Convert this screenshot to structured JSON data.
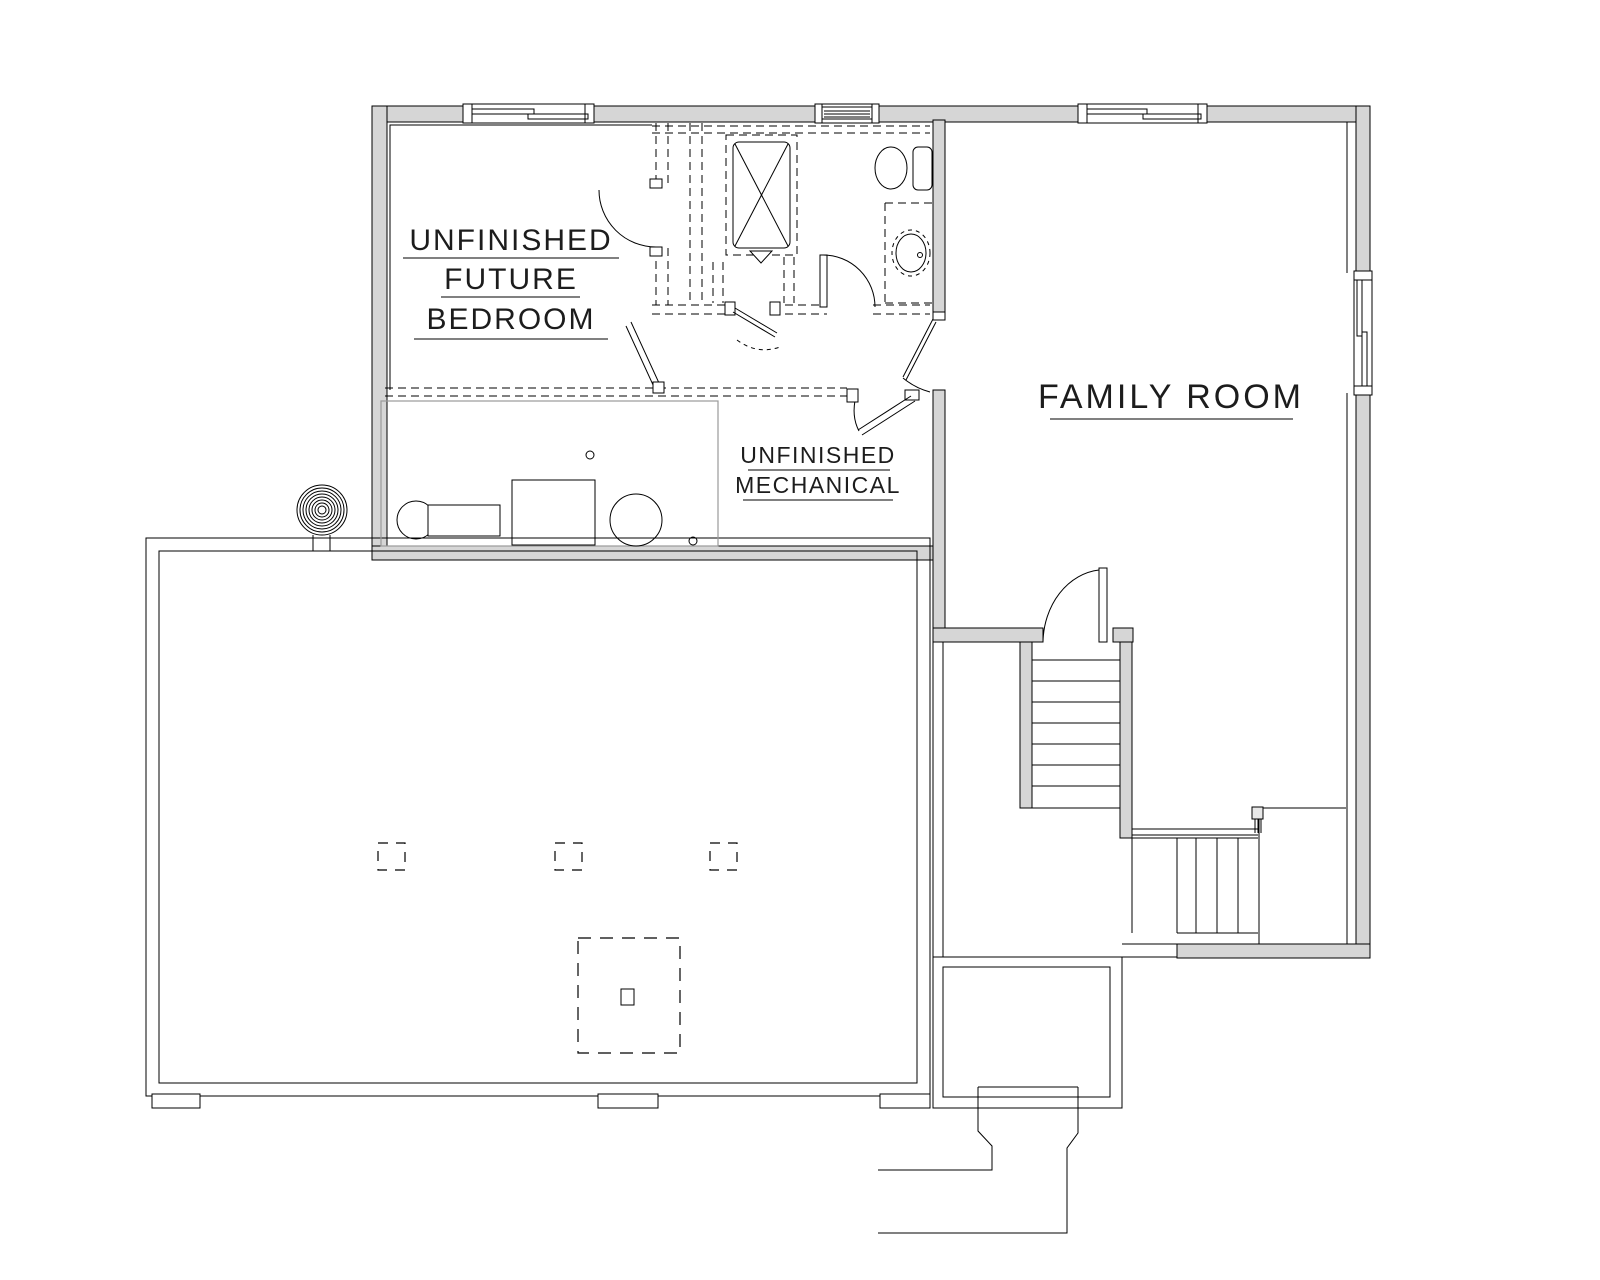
{
  "document": {
    "type": "basement-floor-plan",
    "background": "#ffffff"
  },
  "colors": {
    "wall_fill": "#d6d6d6",
    "line": "#000000",
    "platform_line": "#9a9a9a",
    "text": "#1c1c1c"
  },
  "rooms": {
    "bedroom": {
      "label_lines": [
        "UNFINISHED",
        "FUTURE",
        "BEDROOM"
      ]
    },
    "family_room": {
      "label": "FAMILY ROOM"
    },
    "mechanical": {
      "label_lines": [
        "UNFINISHED",
        "MECHANICAL"
      ]
    }
  },
  "features": [
    "top-wall-window-double",
    "bath-vent-window",
    "family-room-window-top",
    "family-room-window-right",
    "future-bath-shower",
    "toilet",
    "vanity-sink",
    "furnace",
    "water-heater",
    "expansion-tank",
    "sump-coil",
    "stairs-upper-flight",
    "stairs-lower-flight",
    "stair-handrail",
    "door-swings",
    "future-framed-walls-dashed",
    "column-footings",
    "center-footing-pad",
    "garage-foundation",
    "cold-storage-room",
    "foundation-chute"
  ]
}
